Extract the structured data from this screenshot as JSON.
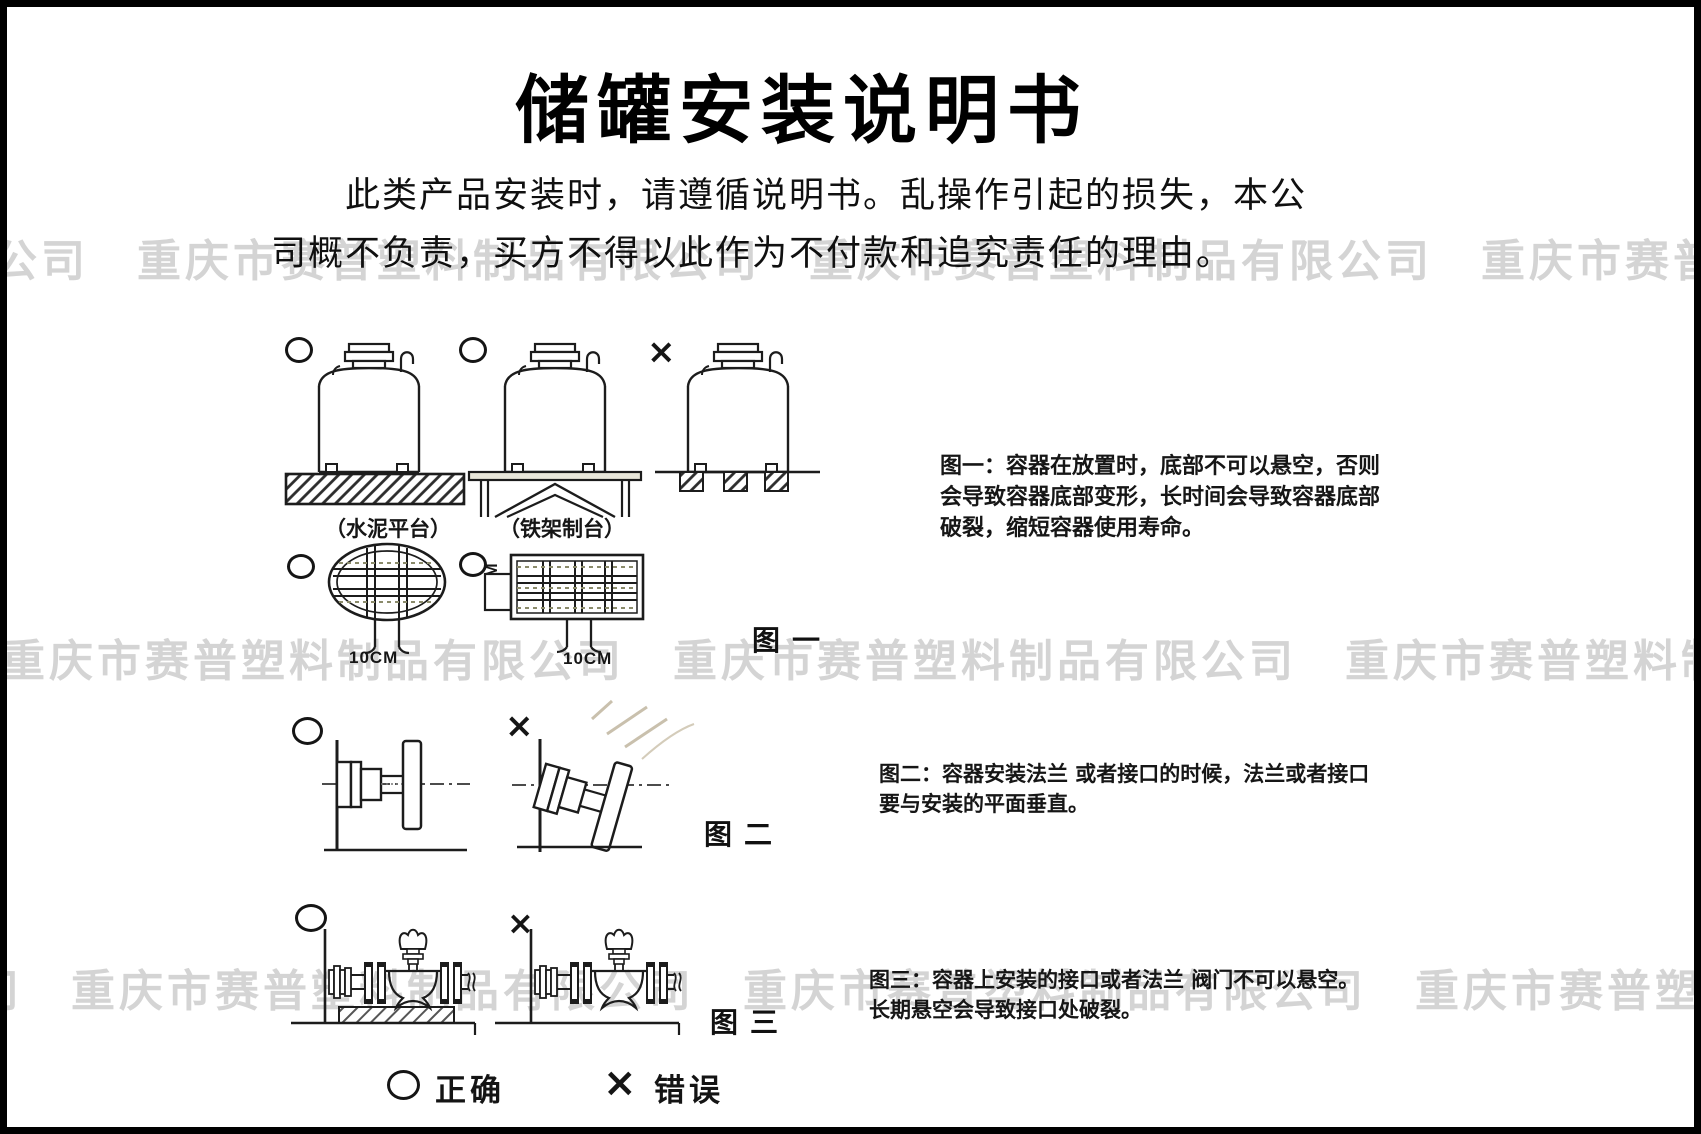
{
  "title": "储罐安装说明书",
  "intro": {
    "line1": "此类产品安装时，请遵循说明书。乱操作引起的损失，本公",
    "line2": "司概不负责，买方不得以此作为不付款和追究责任的理由。"
  },
  "watermark": {
    "company": "重庆市赛普塑料制品有限公司",
    "row_text": "公司　重庆市赛普塑料制品有限公司　重庆市赛普塑料制品有限公司　重庆市赛普塑料制品有限公司　重庆市赛普塑料",
    "color": "#d4d4d4"
  },
  "symbols": {
    "correct": "○",
    "wrong": "×"
  },
  "fig1": {
    "caption": "图一",
    "platform_cement": "（水泥平台）",
    "platform_iron": "（铁架制台）",
    "dim_side": "10CM",
    "dim_bottom_left": "10CM",
    "dim_bottom_right": "10CM",
    "desc": "图一：容器在放置时，底部不可以悬空，否则\n会导致容器底部变形，长时间会导致容器底部\n破裂，缩短容器使用寿命。"
  },
  "fig2": {
    "caption": "图二",
    "desc": "图二：容器安装法兰 或者接口的时候，法兰或者接口\n要与安装的平面垂直。"
  },
  "fig3": {
    "caption": "图三",
    "desc": "图三：容器上安装的接口或者法兰 阀门不可以悬空。\n长期悬空会导致接口处破裂。"
  },
  "legend": {
    "correct_label": "正确",
    "wrong_label": "错误"
  },
  "ink_color": "#1c1c1c"
}
